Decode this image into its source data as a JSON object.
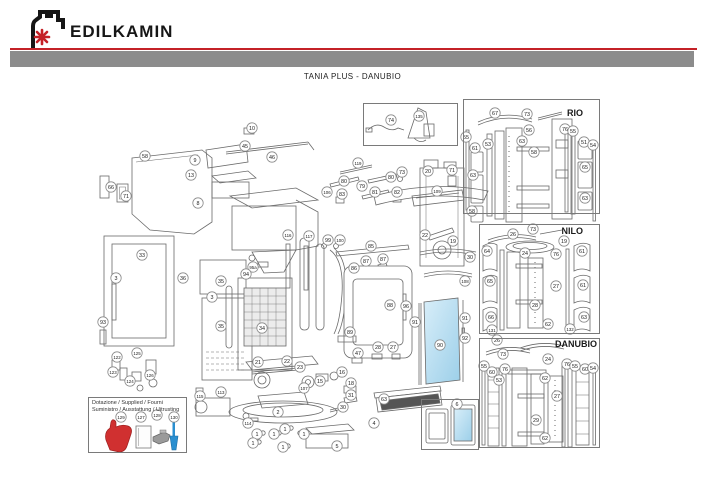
{
  "header": {
    "brand": "EDILKAMIN"
  },
  "title": "TANIA PLUS - DANUBIO",
  "colors": {
    "accent_red": "#c42127",
    "bar_gray": "#8c8c8c",
    "line_art": "#6a6a6a",
    "glass_blue": "#a9d6ec",
    "glove_red": "#d03030",
    "brush_blue": "#2a8fd0"
  },
  "sections": {
    "rio": {
      "label": "RIO"
    },
    "nilo": {
      "label": "NILO"
    },
    "danubio": {
      "label": "DANUBIO"
    }
  },
  "dotazione": {
    "line1": "Dotazione / Supplied / Fourni",
    "line2": "Suministro / Ausstattung / Uitrusting",
    "items": [
      {
        "n": "129",
        "name": "heat-glove"
      },
      {
        "n": "127",
        "name": "user-manual"
      },
      {
        "n": "128",
        "name": "scraper-tool"
      },
      {
        "n": "130",
        "name": "cleaning-brush"
      }
    ]
  },
  "callouts": [
    {
      "n": "74",
      "x": 391,
      "y": 120
    },
    {
      "n": "135",
      "x": 419,
      "y": 116
    },
    {
      "n": "10",
      "x": 252,
      "y": 128
    },
    {
      "n": "45",
      "x": 245,
      "y": 146
    },
    {
      "n": "46",
      "x": 272,
      "y": 157
    },
    {
      "n": "58",
      "x": 145,
      "y": 156
    },
    {
      "n": "9",
      "x": 195,
      "y": 160
    },
    {
      "n": "13",
      "x": 191,
      "y": 175
    },
    {
      "n": "8",
      "x": 198,
      "y": 203
    },
    {
      "n": "66",
      "x": 111,
      "y": 187
    },
    {
      "n": "71",
      "x": 126,
      "y": 196
    },
    {
      "n": "119",
      "x": 358,
      "y": 163
    },
    {
      "n": "80",
      "x": 344,
      "y": 181
    },
    {
      "n": "80",
      "x": 391,
      "y": 177
    },
    {
      "n": "79",
      "x": 362,
      "y": 186
    },
    {
      "n": "73",
      "x": 402,
      "y": 172
    },
    {
      "n": "71",
      "x": 452,
      "y": 170
    },
    {
      "n": "20",
      "x": 428,
      "y": 171
    },
    {
      "n": "109",
      "x": 437,
      "y": 191
    },
    {
      "n": "81",
      "x": 375,
      "y": 192
    },
    {
      "n": "82",
      "x": 397,
      "y": 192
    },
    {
      "n": "83",
      "x": 342,
      "y": 194
    },
    {
      "n": "106",
      "x": 327,
      "y": 192
    },
    {
      "n": "116",
      "x": 288,
      "y": 235
    },
    {
      "n": "117",
      "x": 309,
      "y": 236
    },
    {
      "n": "99",
      "x": 328,
      "y": 240
    },
    {
      "n": "100",
      "x": 340,
      "y": 240
    },
    {
      "n": "85",
      "x": 371,
      "y": 246
    },
    {
      "n": "87",
      "x": 366,
      "y": 261
    },
    {
      "n": "87",
      "x": 383,
      "y": 259
    },
    {
      "n": "86",
      "x": 354,
      "y": 268
    },
    {
      "n": "88",
      "x": 390,
      "y": 305
    },
    {
      "n": "96",
      "x": 406,
      "y": 306
    },
    {
      "n": "89",
      "x": 350,
      "y": 332
    },
    {
      "n": "47",
      "x": 358,
      "y": 353
    },
    {
      "n": "28",
      "x": 378,
      "y": 347
    },
    {
      "n": "27",
      "x": 393,
      "y": 347
    },
    {
      "n": "22",
      "x": 425,
      "y": 235
    },
    {
      "n": "19",
      "x": 453,
      "y": 241
    },
    {
      "n": "30",
      "x": 470,
      "y": 257
    },
    {
      "n": "108",
      "x": 465,
      "y": 281
    },
    {
      "n": "91",
      "x": 415,
      "y": 322
    },
    {
      "n": "91",
      "x": 465,
      "y": 318
    },
    {
      "n": "92",
      "x": 465,
      "y": 338
    },
    {
      "n": "90",
      "x": 440,
      "y": 345
    },
    {
      "n": "33",
      "x": 142,
      "y": 255
    },
    {
      "n": "3",
      "x": 116,
      "y": 278
    },
    {
      "n": "93",
      "x": 103,
      "y": 322
    },
    {
      "n": "36",
      "x": 183,
      "y": 278
    },
    {
      "n": "3",
      "x": 212,
      "y": 297
    },
    {
      "n": "35",
      "x": 221,
      "y": 281
    },
    {
      "n": "35",
      "x": 221,
      "y": 326
    },
    {
      "n": "95a",
      "x": 253,
      "y": 267
    },
    {
      "n": "94",
      "x": 246,
      "y": 274
    },
    {
      "n": "34",
      "x": 262,
      "y": 328
    },
    {
      "n": "125",
      "x": 137,
      "y": 353
    },
    {
      "n": "122",
      "x": 117,
      "y": 357
    },
    {
      "n": "123",
      "x": 113,
      "y": 372
    },
    {
      "n": "124",
      "x": 130,
      "y": 381
    },
    {
      "n": "126",
      "x": 150,
      "y": 375
    },
    {
      "n": "21",
      "x": 258,
      "y": 362
    },
    {
      "n": "22",
      "x": 287,
      "y": 361
    },
    {
      "n": "23",
      "x": 300,
      "y": 367
    },
    {
      "n": "16",
      "x": 342,
      "y": 372
    },
    {
      "n": "15",
      "x": 320,
      "y": 381
    },
    {
      "n": "18",
      "x": 351,
      "y": 383
    },
    {
      "n": "31",
      "x": 351,
      "y": 395
    },
    {
      "n": "30",
      "x": 343,
      "y": 407
    },
    {
      "n": "107",
      "x": 304,
      "y": 388
    },
    {
      "n": "113",
      "x": 221,
      "y": 392
    },
    {
      "n": "115",
      "x": 200,
      "y": 396
    },
    {
      "n": "114",
      "x": 248,
      "y": 423
    },
    {
      "n": "2",
      "x": 278,
      "y": 412
    },
    {
      "n": "5",
      "x": 337,
      "y": 446
    },
    {
      "n": "1",
      "x": 257,
      "y": 434
    },
    {
      "n": "1",
      "x": 274,
      "y": 434
    },
    {
      "n": "1",
      "x": 285,
      "y": 429
    },
    {
      "n": "1",
      "x": 304,
      "y": 434
    },
    {
      "n": "1",
      "x": 253,
      "y": 443
    },
    {
      "n": "1",
      "x": 283,
      "y": 447
    },
    {
      "n": "63",
      "x": 384,
      "y": 399
    },
    {
      "n": "4",
      "x": 374,
      "y": 423
    },
    {
      "n": "6",
      "x": 457,
      "y": 404
    },
    {
      "n": "67",
      "x": 495,
      "y": 113
    },
    {
      "n": "73",
      "x": 527,
      "y": 114
    },
    {
      "n": "56",
      "x": 529,
      "y": 130
    },
    {
      "n": "63",
      "x": 522,
      "y": 141
    },
    {
      "n": "58",
      "x": 534,
      "y": 152
    },
    {
      "n": "55",
      "x": 466,
      "y": 137
    },
    {
      "n": "61",
      "x": 475,
      "y": 148
    },
    {
      "n": "53",
      "x": 488,
      "y": 144
    },
    {
      "n": "63",
      "x": 473,
      "y": 175
    },
    {
      "n": "58",
      "x": 472,
      "y": 211
    },
    {
      "n": "76",
      "x": 565,
      "y": 129
    },
    {
      "n": "55",
      "x": 573,
      "y": 131
    },
    {
      "n": "51",
      "x": 584,
      "y": 142
    },
    {
      "n": "54",
      "x": 593,
      "y": 145
    },
    {
      "n": "65",
      "x": 585,
      "y": 167
    },
    {
      "n": "63",
      "x": 585,
      "y": 198
    },
    {
      "n": "26",
      "x": 513,
      "y": 234
    },
    {
      "n": "73",
      "x": 533,
      "y": 229
    },
    {
      "n": "19",
      "x": 564,
      "y": 241
    },
    {
      "n": "24",
      "x": 525,
      "y": 253
    },
    {
      "n": "76",
      "x": 556,
      "y": 254
    },
    {
      "n": "61",
      "x": 582,
      "y": 251
    },
    {
      "n": "64",
      "x": 487,
      "y": 251
    },
    {
      "n": "65",
      "x": 490,
      "y": 281
    },
    {
      "n": "66",
      "x": 491,
      "y": 317
    },
    {
      "n": "27",
      "x": 556,
      "y": 286
    },
    {
      "n": "28",
      "x": 535,
      "y": 305
    },
    {
      "n": "62",
      "x": 548,
      "y": 324
    },
    {
      "n": "61",
      "x": 583,
      "y": 285
    },
    {
      "n": "63",
      "x": 584,
      "y": 317
    },
    {
      "n": "131",
      "x": 492,
      "y": 330
    },
    {
      "n": "132",
      "x": 570,
      "y": 329
    },
    {
      "n": "26",
      "x": 497,
      "y": 340
    },
    {
      "n": "73",
      "x": 503,
      "y": 354
    },
    {
      "n": "24",
      "x": 548,
      "y": 359
    },
    {
      "n": "76",
      "x": 567,
      "y": 364
    },
    {
      "n": "55",
      "x": 575,
      "y": 366
    },
    {
      "n": "60",
      "x": 585,
      "y": 369
    },
    {
      "n": "54",
      "x": 593,
      "y": 368
    },
    {
      "n": "55",
      "x": 484,
      "y": 366
    },
    {
      "n": "60",
      "x": 492,
      "y": 372
    },
    {
      "n": "76",
      "x": 505,
      "y": 369
    },
    {
      "n": "53",
      "x": 499,
      "y": 380
    },
    {
      "n": "62",
      "x": 545,
      "y": 378
    },
    {
      "n": "27",
      "x": 557,
      "y": 396
    },
    {
      "n": "29",
      "x": 536,
      "y": 420
    },
    {
      "n": "62",
      "x": 545,
      "y": 438
    },
    {
      "n": "129",
      "x": 121,
      "y": 417
    },
    {
      "n": "127",
      "x": 141,
      "y": 417
    },
    {
      "n": "128",
      "x": 157,
      "y": 415
    },
    {
      "n": "130",
      "x": 174,
      "y": 417
    }
  ]
}
